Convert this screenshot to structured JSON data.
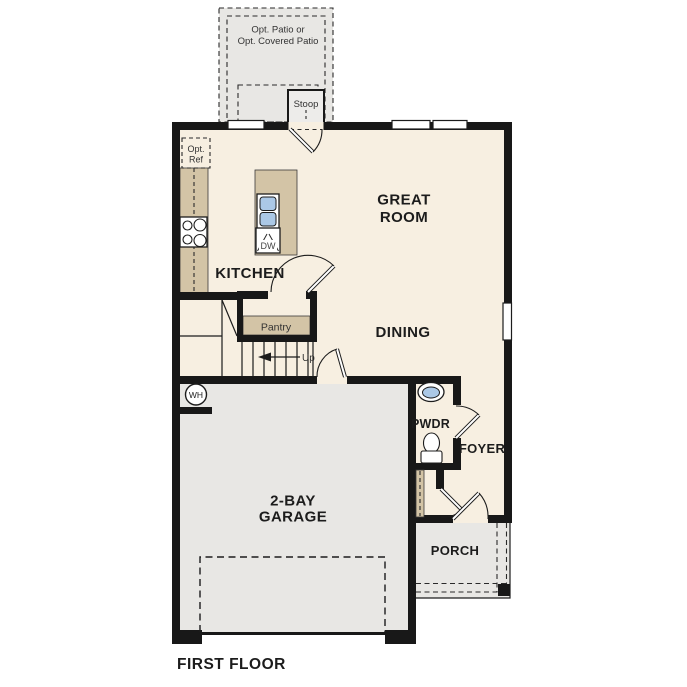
{
  "page_title": "FIRST FLOOR",
  "plan": {
    "floor_title": "FIRST FLOOR",
    "rooms": {
      "great_room": {
        "line1": "GREAT",
        "line2": "ROOM"
      },
      "kitchen": {
        "label": "KITCHEN"
      },
      "dining": {
        "label": "DINING"
      },
      "pwdr": {
        "label": "PWDR"
      },
      "foyer": {
        "label": "FOYER"
      },
      "garage": {
        "line1": "2-BAY",
        "line2": "GARAGE"
      },
      "porch": {
        "label": "PORCH"
      },
      "pantry": {
        "label": "Pantry"
      },
      "stoop": {
        "label": "Stoop"
      },
      "patio": {
        "line1": "Opt. Patio or",
        "line2": "Opt. Covered Patio"
      }
    },
    "fixtures": {
      "refrigerator": {
        "line1": "Opt.",
        "line2": "Ref"
      },
      "dishwasher": {
        "label": "DW"
      },
      "water_heater": {
        "label": "WH"
      }
    },
    "annotations": {
      "stairs_up": "Up"
    },
    "palette": {
      "wall": "#181818",
      "floor": "#f7efe1",
      "concrete": "#e8e7e4",
      "casework_tan": "#d3c4a6",
      "fixture_blue": "#abc8e6"
    }
  }
}
